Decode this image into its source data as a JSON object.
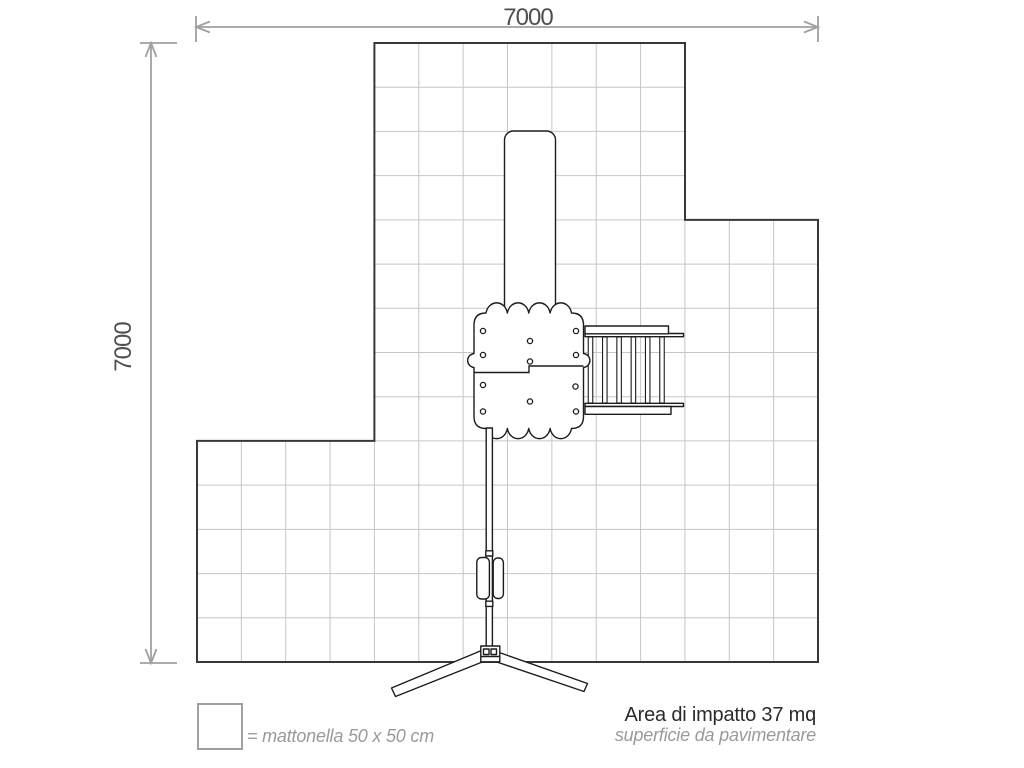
{
  "dimensions": {
    "top_label": "7000",
    "left_label": "7000"
  },
  "grid": {
    "columns": 14,
    "rows": 14,
    "tile_count": 148
  },
  "legend": {
    "tile_label": "= mattonella 50 x 50 cm"
  },
  "impact_area": {
    "title": "Area di impatto 37 mq",
    "subtitle": "superficie da pavimentare"
  },
  "colors": {
    "dimension": "#a0a0a0",
    "dimension_text": "#4f4f4f",
    "grid_line": "#c6c6c6",
    "outline": "#383838",
    "equipment": "#1c1c1c",
    "caption_gray": "#9a9a9a",
    "title_dark": "#2b2b2b",
    "background": "#ffffff"
  }
}
